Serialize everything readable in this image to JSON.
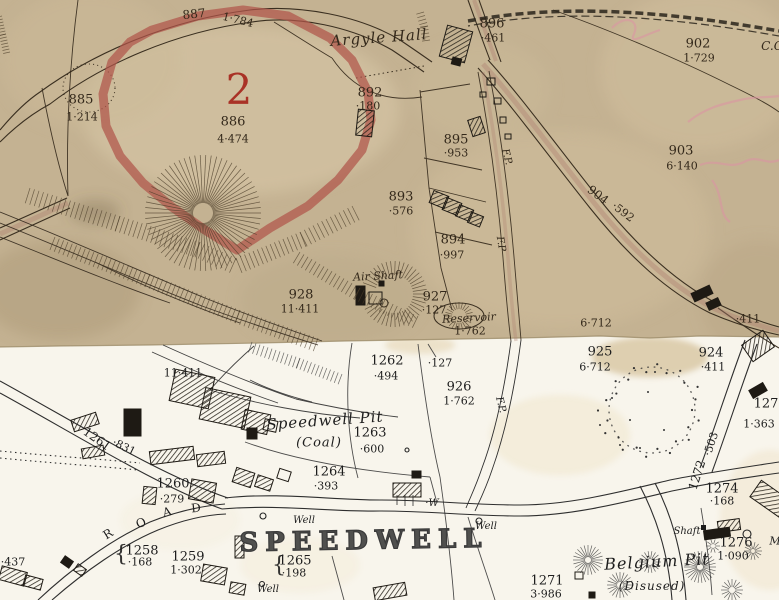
{
  "map": {
    "description": "Historic Ordnance Survey map extract: two joined sheets (aged sepia sheet above, white sheet below) around Speedwell Pit and Belgium Pit",
    "colors": {
      "sepia_paper": "#c4b292",
      "white_paper": "#f8f5ec",
      "sepia_ink": "#33281a",
      "black_ink": "#1d1d1d",
      "red_parcel_band": "#b0544a",
      "red_numeral": "#a93226",
      "road_tint": "#b08070",
      "pink_annotation": "#dd93a4"
    },
    "label_fields": [
      "name",
      "text",
      "x",
      "y",
      "size",
      "rot",
      "ink",
      "style",
      "letter_spacing"
    ],
    "labels": [
      [
        "parcel-887-number",
        "887",
        194,
        14,
        12,
        -6,
        "sepia",
        "number",
        0
      ],
      [
        "parcel-887-area",
        "1·784",
        238,
        20,
        11,
        14,
        "sepia",
        "number",
        0
      ],
      [
        "argyle-hall-name",
        "Argyle Hall",
        379,
        38,
        15,
        -4,
        "sepia",
        "name",
        1
      ],
      [
        "parcel-896-number",
        "896",
        492,
        24,
        13,
        0,
        "sepia",
        "number",
        0
      ],
      [
        "parcel-896-area",
        "·461",
        493,
        38,
        11,
        0,
        "sepia",
        "number",
        0
      ],
      [
        "parcel-902-number",
        "902",
        698,
        44,
        13,
        0,
        "sepia",
        "number",
        0
      ],
      [
        "parcel-902-area",
        "1·729",
        699,
        58,
        11,
        0,
        "sepia",
        "number",
        0
      ],
      [
        "boundary-abbrev",
        "C.C",
        772,
        46,
        12,
        0,
        "sepia",
        "name",
        0
      ],
      [
        "parcel-885-number",
        "885",
        81,
        100,
        13,
        0,
        "sepia",
        "number",
        0
      ],
      [
        "parcel-885-area",
        "1·214",
        82,
        117,
        11,
        0,
        "sepia",
        "number",
        0
      ],
      [
        "plot-2-red-numeral",
        "2",
        239,
        90,
        42,
        0,
        "red",
        "number",
        0
      ],
      [
        "parcel-886-number",
        "886",
        233,
        122,
        13,
        0,
        "sepia",
        "number",
        0
      ],
      [
        "parcel-886-area",
        "4·474",
        233,
        139,
        11,
        0,
        "sepia",
        "number",
        0
      ],
      [
        "parcel-892-number",
        "892",
        370,
        93,
        13,
        0,
        "sepia",
        "number",
        0
      ],
      [
        "parcel-892-area",
        "·180",
        368,
        106,
        11,
        0,
        "sepia",
        "number",
        0
      ],
      [
        "parcel-895-number",
        "895",
        456,
        140,
        13,
        0,
        "sepia",
        "number",
        0
      ],
      [
        "parcel-895-area",
        "·953",
        456,
        153,
        11,
        0,
        "sepia",
        "number",
        0
      ],
      [
        "parcel-903-number",
        "903",
        681,
        151,
        13,
        0,
        "sepia",
        "number",
        0
      ],
      [
        "parcel-903-area",
        "6·140",
        682,
        166,
        11,
        0,
        "sepia",
        "number",
        0
      ],
      [
        "parcel-904-number",
        "904",
        598,
        195,
        12,
        37,
        "sepia",
        "number",
        0
      ],
      [
        "parcel-904-area",
        "·592",
        623,
        212,
        11,
        37,
        "sepia",
        "number",
        0
      ],
      [
        "parcel-893-number",
        "893",
        401,
        197,
        13,
        0,
        "sepia",
        "number",
        0
      ],
      [
        "parcel-893-area",
        "·576",
        401,
        211,
        11,
        0,
        "sepia",
        "number",
        0
      ],
      [
        "parcel-894-number",
        "894",
        453,
        240,
        13,
        0,
        "sepia",
        "number",
        0
      ],
      [
        "parcel-894-area",
        "·997",
        452,
        255,
        11,
        0,
        "sepia",
        "number",
        0
      ],
      [
        "footpath-label-1",
        "F.P.",
        506,
        157,
        10,
        75,
        "sepia",
        "name",
        0
      ],
      [
        "footpath-label-2",
        "F.P",
        500,
        244,
        10,
        80,
        "sepia",
        "name",
        0
      ],
      [
        "air-shaft-name",
        "Air Shaft",
        378,
        276,
        11,
        -3,
        "sepia",
        "name",
        0
      ],
      [
        "parcel-928-number",
        "928",
        301,
        295,
        13,
        0,
        "sepia",
        "number",
        0
      ],
      [
        "parcel-928-area",
        "11·411",
        300,
        309,
        11,
        0,
        "sepia",
        "number",
        0
      ],
      [
        "parcel-927-number",
        "927",
        435,
        297,
        13,
        0,
        "sepia",
        "number",
        0
      ],
      [
        "parcel-927-area",
        "·127",
        434,
        310,
        11,
        0,
        "sepia",
        "number",
        0
      ],
      [
        "reservoir-name",
        "Reservoir",
        469,
        318,
        11,
        -3,
        "sepia",
        "name",
        0
      ],
      [
        "reservoir-area",
        "1·762",
        470,
        331,
        11,
        0,
        "sepia",
        "number",
        0
      ],
      [
        "area-6712-old",
        "6·712",
        596,
        323,
        11,
        0,
        "sepia",
        "number",
        0
      ],
      [
        "area-411-old",
        "·411",
        748,
        319,
        11,
        0,
        "sepia",
        "number",
        0
      ],
      [
        "parcel-925-number",
        "925",
        600,
        352,
        13,
        0,
        "black",
        "number",
        0
      ],
      [
        "parcel-925-area",
        "6·712",
        595,
        367,
        11,
        0,
        "black",
        "number",
        0
      ],
      [
        "parcel-924-number",
        "924",
        711,
        353,
        13,
        0,
        "black",
        "number",
        0
      ],
      [
        "parcel-924-area",
        "·411",
        713,
        367,
        11,
        0,
        "black",
        "number",
        0
      ],
      [
        "parcel-1262-number",
        "1262",
        387,
        361,
        13,
        0,
        "black",
        "number",
        0
      ],
      [
        "parcel-1262-area",
        "·494",
        386,
        376,
        11,
        0,
        "black",
        "number",
        0
      ],
      [
        "parcel-927-area-new",
        "·127",
        440,
        363,
        11,
        0,
        "black",
        "number",
        0
      ],
      [
        "parcel-926-number",
        "926",
        459,
        387,
        13,
        0,
        "black",
        "number",
        0
      ],
      [
        "parcel-926-area",
        "1·762",
        459,
        401,
        11,
        0,
        "black",
        "number",
        0
      ],
      [
        "footpath-label-3",
        "F.P.",
        500,
        405,
        10,
        75,
        "black",
        "name",
        0
      ],
      [
        "area-11411-new",
        "11·411",
        183,
        373,
        11,
        0,
        "black",
        "number",
        0
      ],
      [
        "speedwell-pit-name",
        "Speedwell Pit",
        325,
        421,
        15,
        -4,
        "black",
        "name",
        1
      ],
      [
        "speedwell-pit-type",
        "(Coal)",
        319,
        443,
        13,
        0,
        "black",
        "name",
        1
      ],
      [
        "parcel-1263-number",
        "1263",
        370,
        433,
        13,
        0,
        "black",
        "number",
        0
      ],
      [
        "parcel-1263-area",
        "·600",
        372,
        449,
        11,
        0,
        "black",
        "number",
        0
      ],
      [
        "parcel-1261-number",
        "1261",
        97,
        439,
        12,
        35,
        "black",
        "number",
        0
      ],
      [
        "parcel-1261-area",
        "·831",
        124,
        447,
        11,
        26,
        "black",
        "number",
        0
      ],
      [
        "parcel-1264-number",
        "1264",
        329,
        472,
        13,
        0,
        "black",
        "number",
        0
      ],
      [
        "parcel-1264-area",
        "·393",
        326,
        486,
        11,
        0,
        "black",
        "number",
        0
      ],
      [
        "parcel-1260-number",
        "1260",
        173,
        484,
        13,
        0,
        "black",
        "number",
        0
      ],
      [
        "parcel-1260-area",
        "·279",
        172,
        499,
        11,
        0,
        "black",
        "number",
        0
      ],
      [
        "road-letter-r",
        "R",
        108,
        534,
        12,
        -32,
        "black",
        "number",
        0
      ],
      [
        "road-letter-o",
        "O",
        141,
        523,
        12,
        -24,
        "black",
        "number",
        0
      ],
      [
        "road-letter-a",
        "A",
        167,
        512,
        12,
        -14,
        "black",
        "number",
        0
      ],
      [
        "road-letter-d",
        "D",
        196,
        508,
        12,
        -6,
        "black",
        "number",
        0
      ],
      [
        "parcel-1257-area",
        "·437",
        13,
        562,
        11,
        0,
        "black",
        "number",
        0
      ],
      [
        "brace-1258",
        "{",
        121,
        555,
        22,
        0,
        "black",
        "brace",
        0
      ],
      [
        "parcel-1258-number",
        "1258",
        142,
        551,
        13,
        0,
        "black",
        "number",
        0
      ],
      [
        "parcel-1258-area",
        "·168",
        140,
        562,
        11,
        0,
        "black",
        "number",
        0
      ],
      [
        "parcel-1259-number",
        "1259",
        188,
        557,
        13,
        0,
        "black",
        "number",
        0
      ],
      [
        "parcel-1259-area",
        "1·302",
        186,
        570,
        11,
        0,
        "black",
        "number",
        0
      ],
      [
        "speedwell-village-name",
        "SPEEDWELL",
        364,
        541,
        26,
        -1,
        "black",
        "hollow",
        7
      ],
      [
        "brace-1265",
        "{",
        279,
        566,
        22,
        0,
        "black",
        "brace",
        0
      ],
      [
        "parcel-1265-number",
        "1265",
        295,
        561,
        13,
        0,
        "black",
        "number",
        0
      ],
      [
        "parcel-1265-area",
        "·198",
        294,
        573,
        11,
        0,
        "black",
        "number",
        0
      ],
      [
        "well-label-1",
        "Well",
        304,
        521,
        10,
        0,
        "black",
        "name",
        0
      ],
      [
        "well-label-w",
        "·W",
        432,
        504,
        10,
        0,
        "black",
        "name",
        0
      ],
      [
        "well-label-2",
        "Well",
        486,
        527,
        10,
        0,
        "black",
        "name",
        0
      ],
      [
        "well-label-3",
        "Well",
        268,
        590,
        10,
        0,
        "black",
        "name",
        0
      ],
      [
        "parcel-1271-number",
        "1271",
        547,
        581,
        13,
        0,
        "black",
        "number",
        0
      ],
      [
        "parcel-1271-area",
        "3·986",
        546,
        594,
        11,
        0,
        "black",
        "number",
        0
      ],
      [
        "belgium-pit-name",
        "Belgium Pit",
        657,
        562,
        16,
        -3,
        "black",
        "name",
        1
      ],
      [
        "belgium-pit-status",
        "(Disused)",
        652,
        586,
        12,
        0,
        "black",
        "name",
        1
      ],
      [
        "shaft-label",
        "Shaft",
        687,
        532,
        10,
        0,
        "black",
        "name",
        0
      ],
      [
        "parcel-1276-number",
        "1276",
        736,
        543,
        13,
        0,
        "black",
        "number",
        0
      ],
      [
        "parcel-1276-area",
        "1·090",
        733,
        556,
        11,
        0,
        "black",
        "number",
        0
      ],
      [
        "parcel-1274-number",
        "1274",
        722,
        489,
        13,
        0,
        "black",
        "number",
        0
      ],
      [
        "parcel-1274-area",
        "·168",
        722,
        501,
        11,
        0,
        "black",
        "number",
        0
      ],
      [
        "parcel-1272-number",
        "1272",
        697,
        475,
        12,
        -72,
        "black",
        "number",
        0
      ],
      [
        "parcel-1272-area",
        "·503",
        711,
        444,
        11,
        -72,
        "black",
        "number",
        0
      ],
      [
        "parcel-1273-number",
        "127",
        766,
        404,
        13,
        0,
        "black",
        "number",
        0
      ],
      [
        "parcel-1273-area",
        "1·363",
        759,
        424,
        11,
        0,
        "black",
        "number",
        0
      ],
      [
        "edge-letter-m",
        "M",
        775,
        541,
        11,
        0,
        "black",
        "name",
        0
      ]
    ]
  }
}
